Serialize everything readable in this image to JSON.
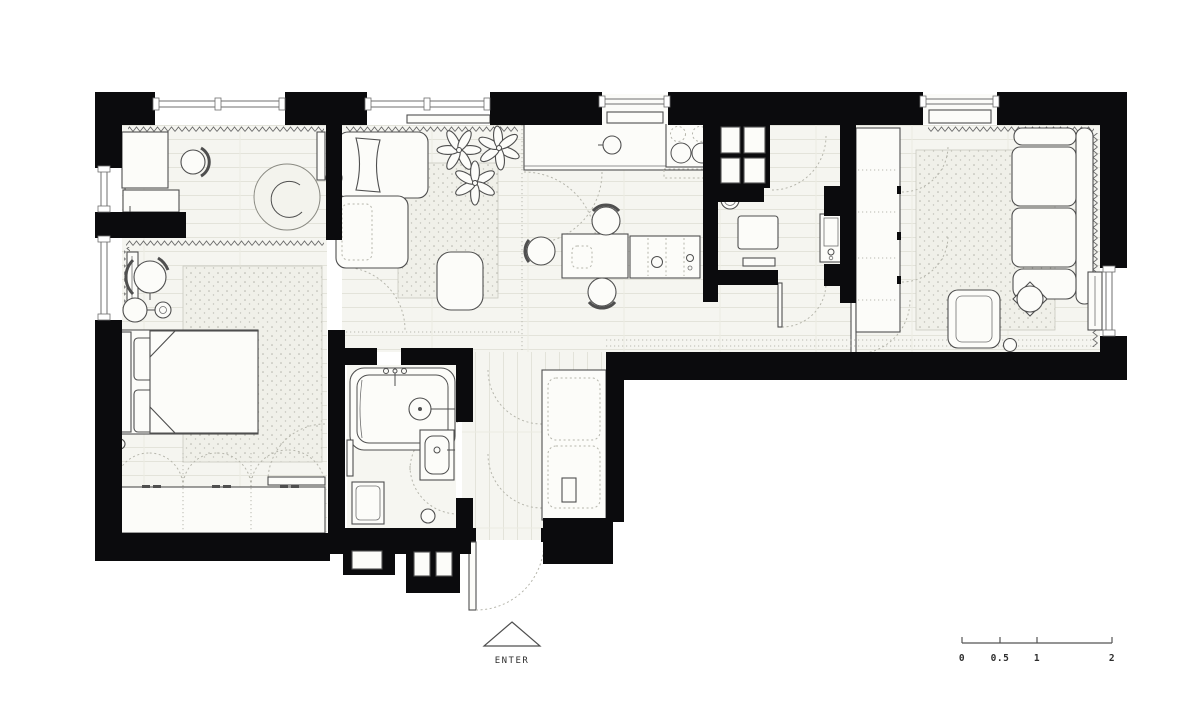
{
  "canvas": {
    "width": 1200,
    "height": 702,
    "background": "#ffffff"
  },
  "colors": {
    "wall": "#0b0b0d",
    "floor": "#f5f5f0",
    "plank_line": "#e3e3da",
    "furniture_fill": "#fcfcf9",
    "furniture_stroke": "#4f4f4f",
    "rug_fill": "#f0f0e9",
    "rug_dot": "#b4b4ab",
    "dash_line": "#b6b6ac",
    "zigzag": "#6a6a6a",
    "text": "#2e2e2e"
  },
  "entry": {
    "label": "ENTER"
  },
  "scale_bar": {
    "labels": [
      "0",
      "0.5",
      "1",
      "2"
    ]
  }
}
